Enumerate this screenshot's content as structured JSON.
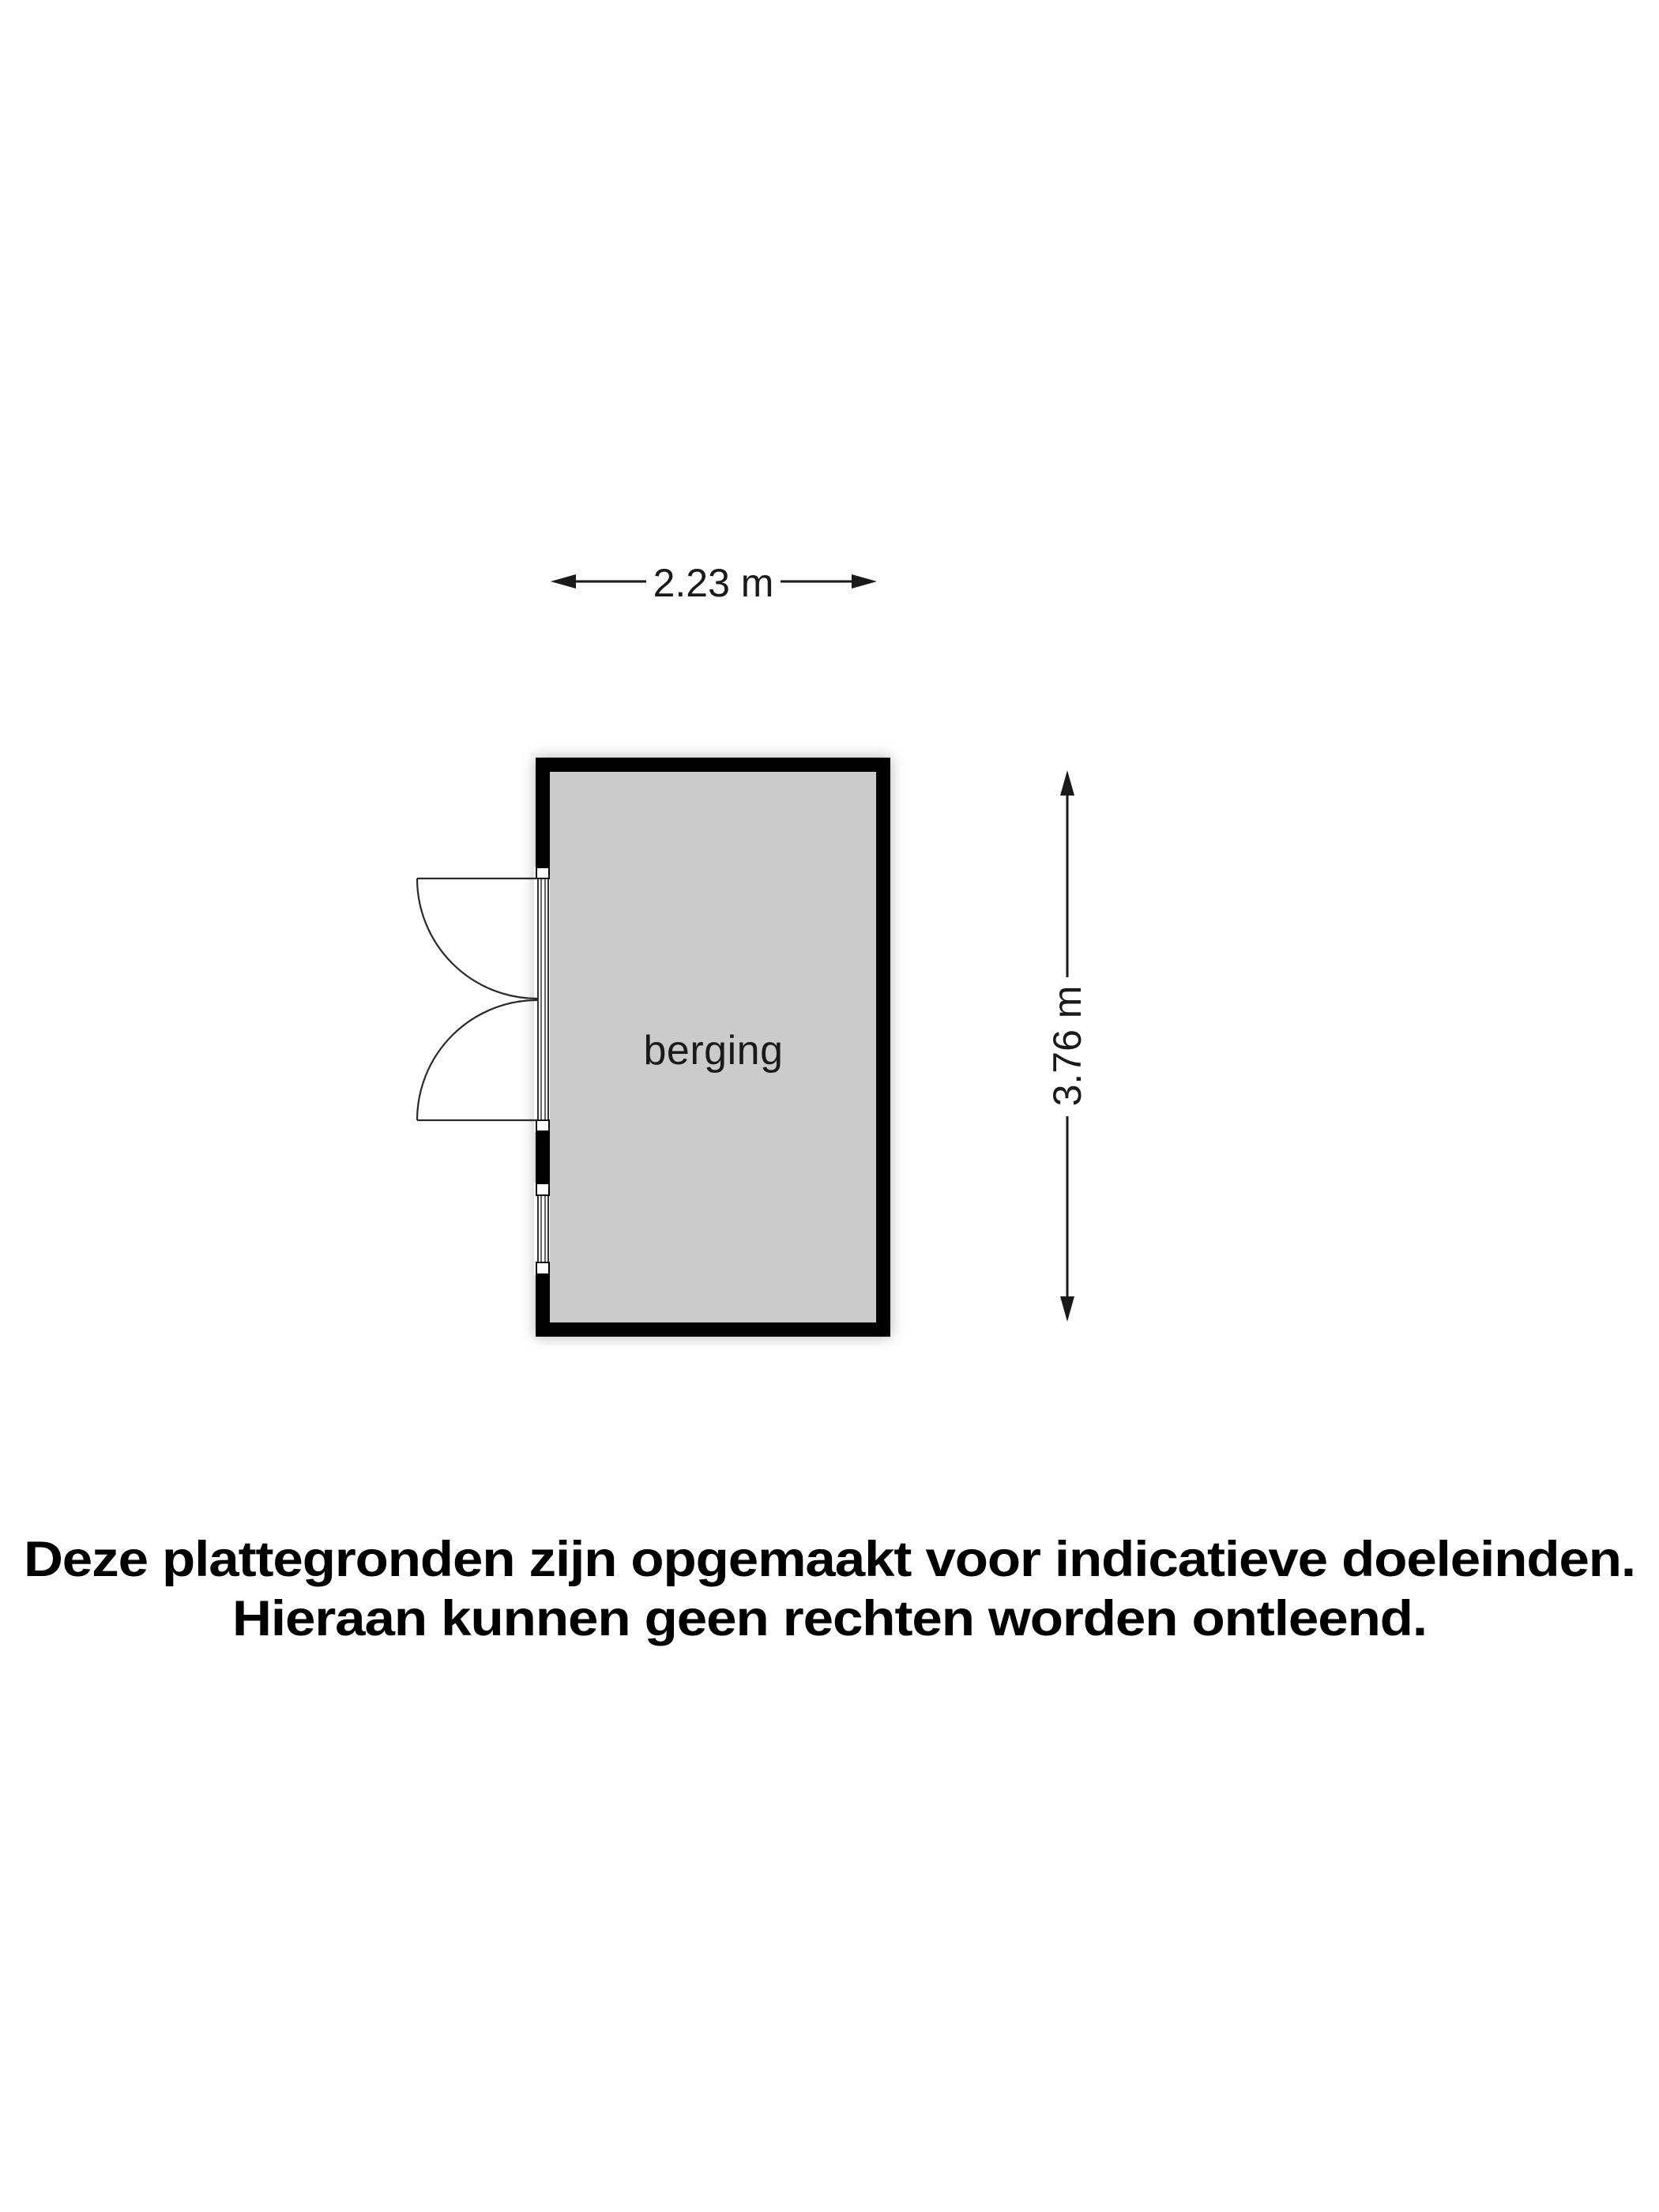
{
  "plan": {
    "room_label": "berging",
    "width_label": "2.23 m",
    "height_label": "3.76 m"
  },
  "disclaimer": {
    "line1": "Deze plattegronden zijn opgemaakt voor indicatieve doeleinden.",
    "line2": "Hieraan kunnen geen rechten worden ontleend."
  },
  "colors": {
    "floor": "#cbcbcb",
    "wall": "#000000",
    "line": "#1a1a1a",
    "background": "#ffffff"
  }
}
